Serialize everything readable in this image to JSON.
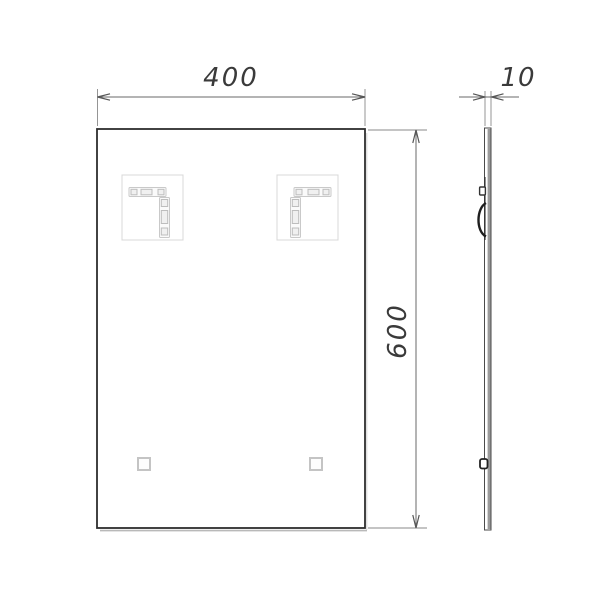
{
  "drawing": {
    "subject": "Rectangular mirror technical drawing - front view and side profile view",
    "front_view": {
      "width_label": "400",
      "height_label": "600"
    },
    "side_view": {
      "thickness_label": "10"
    },
    "colors": {
      "background": "#ffffff",
      "object_outline": "#2d2d2d",
      "dimension_line": "#6a6a6a",
      "extension_line": "#8a8a8a",
      "dimension_text": "#3a3a3a",
      "light_detail": "#d0d0d0",
      "side_shading": "#9a9a9a"
    }
  }
}
